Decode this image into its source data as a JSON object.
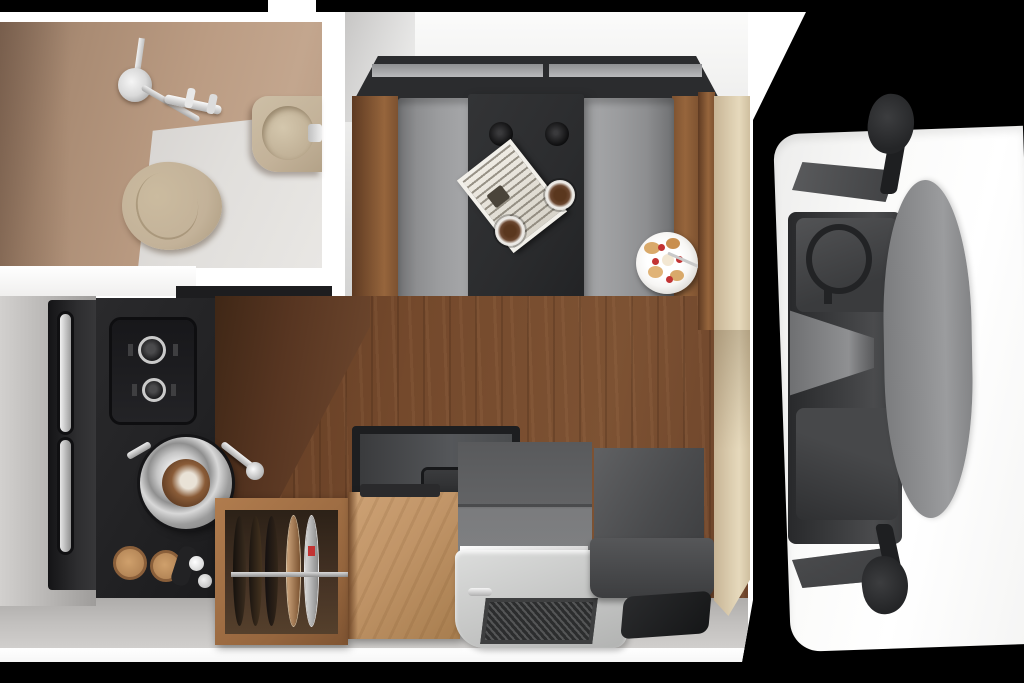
{
  "scene": {
    "type": "floor-plan-render",
    "subject": "truck camper interior, top-down view",
    "areas": {
      "bathroom": {
        "items": [
          "shower-fixture",
          "wash-basin",
          "toilet"
        ]
      },
      "dinette": {
        "items": [
          "bench-seat-left",
          "bench-seat-right",
          "dining-table",
          "magazine",
          "coffee-cup",
          "coffee-cup",
          "breakfast-plate",
          "cup-holders"
        ]
      },
      "kitchen": {
        "items": [
          "refrigerator",
          "two-burner-hob",
          "round-sink",
          "faucet",
          "cutting-boards",
          "walnut-counter"
        ]
      },
      "storage": {
        "items": [
          "plate-cabinet",
          "wood-cabinet",
          "cooker-unit"
        ]
      },
      "entry": {
        "items": [
          "step-tray",
          "floor-grille",
          "side-seat",
          "door-mat",
          "partition-panel"
        ]
      },
      "truck_cab": {
        "items": [
          "driver-seat",
          "passenger-seat",
          "steering-wheel",
          "center-console",
          "dashboard",
          "side-mirror-top",
          "side-mirror-bottom"
        ]
      }
    }
  },
  "palette": {
    "bg": "#000000",
    "wall-white": "#ffffff",
    "bath-wall": "#bb9c83",
    "bath-wall-dark": "#8d7360",
    "bath-floor": "#e1dfdc",
    "ceramic": "#c3b299",
    "chrome": "#d9d9d9",
    "bench-gray": "#9b9c9e",
    "bench-dark": "#6f7072",
    "wood-trim": "#96653c",
    "wood-dark": "#5e3a22",
    "table-dark": "#2b2c2e",
    "floor-wood": "#74492c",
    "counter-black": "#232325",
    "walnut": "#573521",
    "cab-light": "#c09467",
    "tray": "#c9cac9",
    "grille": "#2c2d2e",
    "seat-gray": "#4a4b4d",
    "beige-panel": "#d9caac",
    "dash-gray": "#8f9092",
    "mirror-black": "#242527",
    "coffee": "#6b4730",
    "plate-white": "#f7f6f4",
    "berry": "#c23333",
    "pastry": "#d9a96a",
    "floor-gray": "#c2c0be"
  }
}
